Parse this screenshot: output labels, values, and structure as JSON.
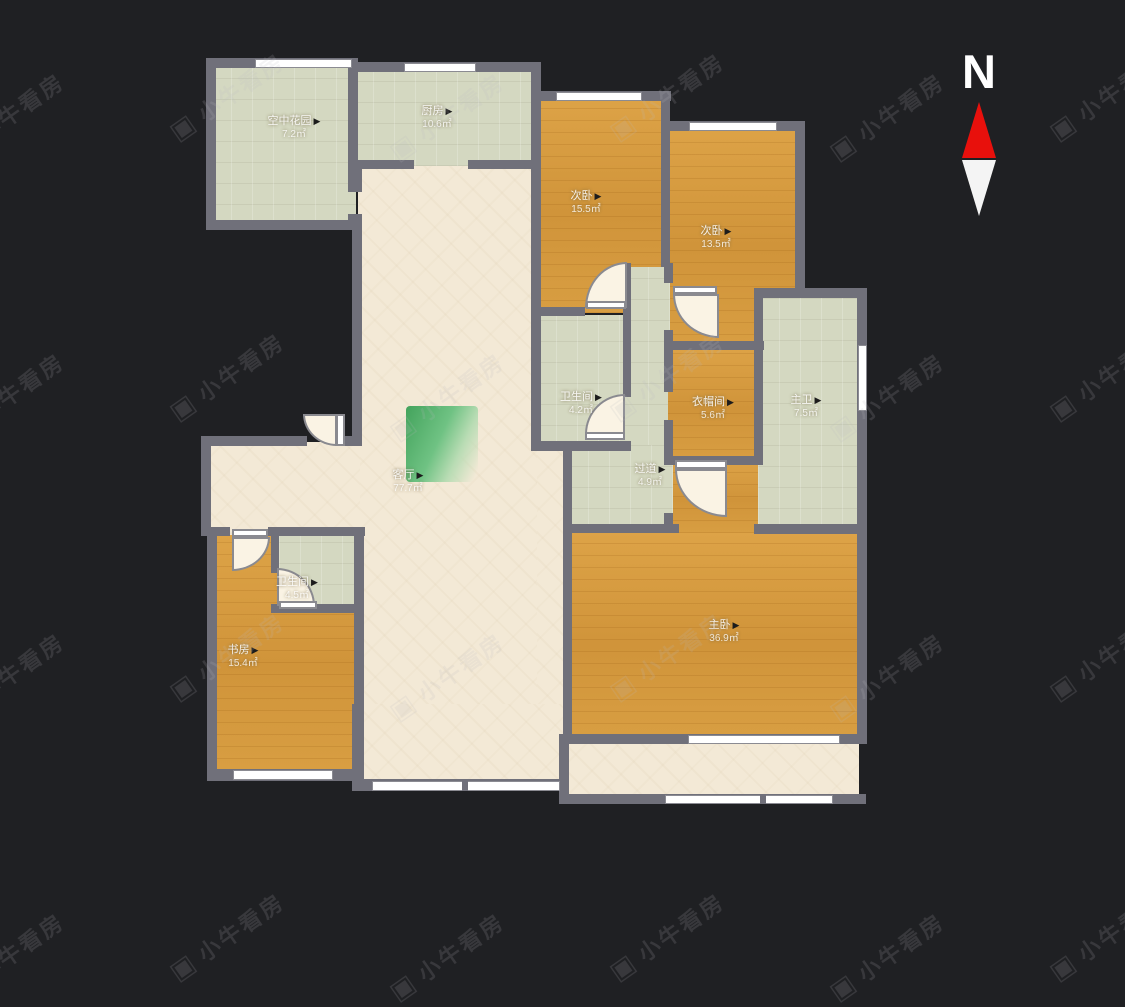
{
  "ui": {
    "arrow": "▶",
    "compass_label": "N"
  },
  "watermark": {
    "text": "小牛看房",
    "icon": "camera-logo-icon"
  },
  "colors": {
    "background": "#1f2023",
    "wall": "#70707a",
    "wood_floor": "#d79b3f",
    "tile_floor": "#d4d8c1",
    "cream_floor": "#f3e9d6",
    "compass_red": "#e8100c",
    "decor_green": "#43a35c"
  },
  "rooms": [
    {
      "id": "sky-garden",
      "name": "空中花园",
      "area": "7.2㎡"
    },
    {
      "id": "kitchen",
      "name": "厨房",
      "area": "10.6㎡"
    },
    {
      "id": "bedroom-north",
      "name": "次卧",
      "area": "15.5㎡"
    },
    {
      "id": "bedroom-east",
      "name": "次卧",
      "area": "13.5㎡"
    },
    {
      "id": "bathroom-middle",
      "name": "卫生间",
      "area": "4.2㎡"
    },
    {
      "id": "cloakroom",
      "name": "衣帽间",
      "area": "5.6㎡"
    },
    {
      "id": "master-bath",
      "name": "主卫",
      "area": "7.5㎡"
    },
    {
      "id": "living-room",
      "name": "客厅",
      "area": "77.7㎡"
    },
    {
      "id": "hallway",
      "name": "过道",
      "area": "4.9㎡"
    },
    {
      "id": "master-bedroom",
      "name": "主卧",
      "area": "36.9㎡"
    },
    {
      "id": "study",
      "name": "书房",
      "area": "15.4㎡"
    },
    {
      "id": "bathroom-small",
      "name": "卫生间",
      "area": "4.5㎡"
    }
  ]
}
